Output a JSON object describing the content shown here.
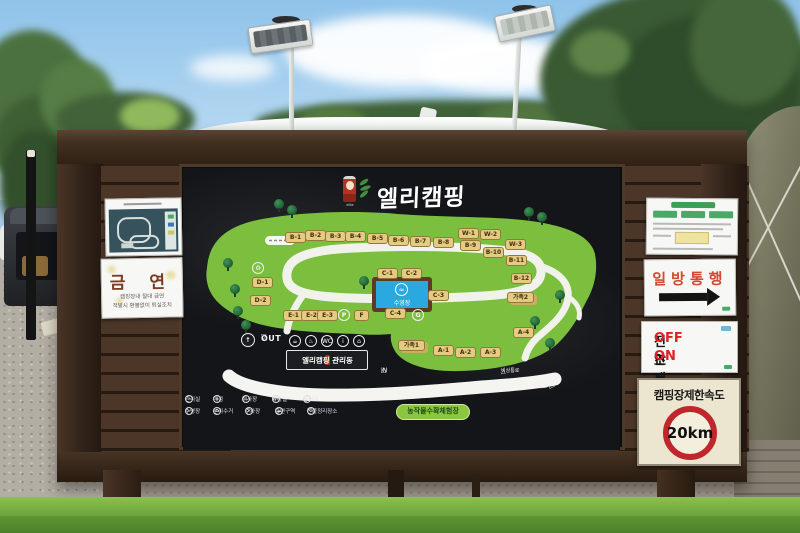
{
  "sign": {
    "brand": {
      "title": "엘리캠핑",
      "logo_sub": "ellie"
    },
    "map": {
      "pool_label": "수영장",
      "sites_top": [
        "B-1",
        "B-2",
        "B-3",
        "B-4",
        "B-5",
        "B-6",
        "B-7",
        "B-8"
      ],
      "sites_right": [
        "B-9",
        "B-10",
        "B-11",
        "B-12"
      ],
      "sites_w": [
        "W-1",
        "W-2",
        "W-3"
      ],
      "sites_c": [
        "C-1",
        "C-2",
        "C-3",
        "C-4"
      ],
      "sites_d": [
        "D-1",
        "D-2"
      ],
      "sites_e": [
        "E-1",
        "E-2",
        "E-3"
      ],
      "sites_a": [
        "A-1",
        "A-2",
        "A-3",
        "A-4"
      ],
      "family1": "가족1",
      "family2": "가족2",
      "f_label": "F",
      "p_label": "P",
      "g_label": "G",
      "recycle_glyph": "♻",
      "up_glyph": "↑",
      "out_label": "OUT",
      "in_label": "IN",
      "emergency_label": "비상통로",
      "trail_label": "산책로",
      "harvest_label": "농작물수확체험장",
      "management_label": "엘리캠핑 관리동",
      "mgmt_icons": [
        "☕",
        "♨",
        "WC",
        "i",
        "⌂"
      ]
    },
    "legend_row1": [
      {
        "icon": "i",
        "label": "관리실"
      },
      {
        "icon": "⌂",
        "label": "매점"
      },
      {
        "icon": "♨",
        "label": "취사장"
      },
      {
        "icon": "WC",
        "label": "화장실"
      },
      {
        "icon": "≈",
        "label": "음수대"
      }
    ],
    "legend_row2": [
      {
        "icon": "≈",
        "label": "수영장"
      },
      {
        "icon": "♻",
        "label": "분리수거"
      },
      {
        "icon": "P",
        "label": "주차장"
      },
      {
        "icon": "☁",
        "label": "흡연구역"
      },
      {
        "icon": "G",
        "label": "잔불정리장소"
      }
    ]
  },
  "notices": {
    "no_smoking": {
      "title": "금 연",
      "line1": "캠핑장내 절대 금연",
      "line2": "적발시 환불없이 퇴실조치"
    },
    "one_way": "일방통행",
    "lights": {
      "label1": "전조등",
      "value1": "OFF",
      "label2": "안개등",
      "value2": "ON"
    },
    "speed": {
      "title": "캠핑장제한속도",
      "value": "20km"
    }
  },
  "colors": {
    "map_green": "#7cbf3f",
    "site_tan": "#e5cb81",
    "pool_blue": "#2aa9e0",
    "speed_ring_red": "#c0272d",
    "wood_brown": "#32231a"
  }
}
